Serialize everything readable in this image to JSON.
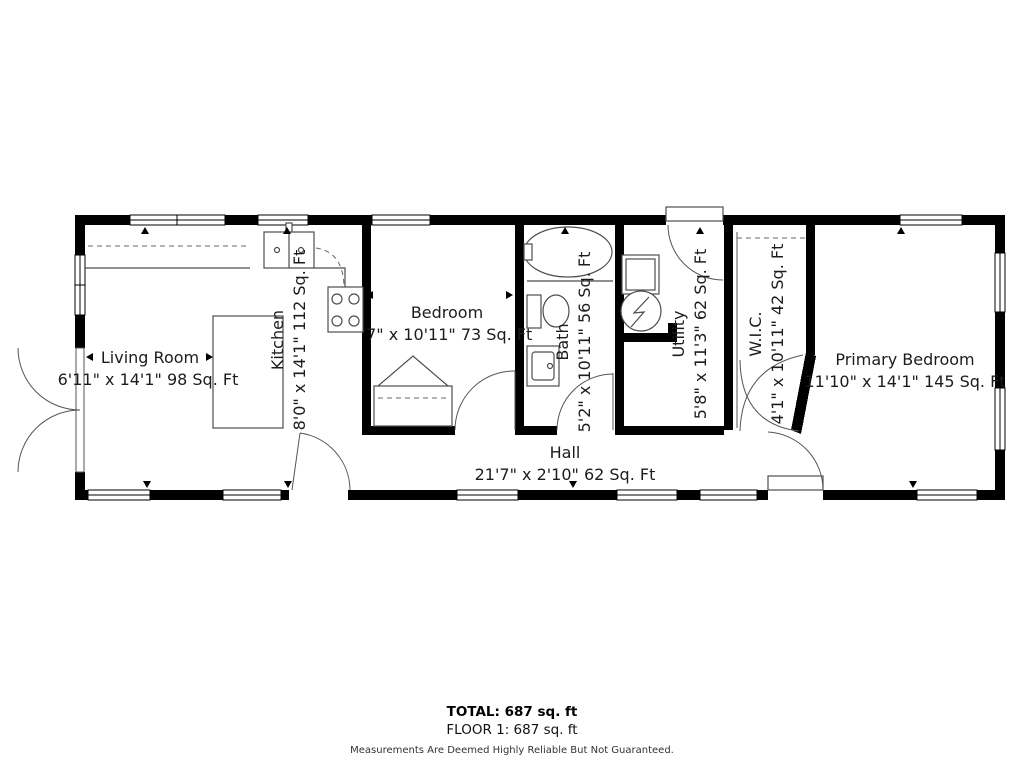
{
  "rooms": {
    "living_room": {
      "name": "Living Room",
      "dims": "6'11\" x 14'1\" 98 Sq. Ft"
    },
    "kitchen": {
      "name": "Kitchen",
      "dims": "8'0\" x 14'1\" 112 Sq. Ft"
    },
    "bedroom": {
      "name": "Bedroom",
      "dims": "'7\" x 10'11\" 73 Sq. Ft"
    },
    "bath": {
      "name": "Bath",
      "dims": "5'2\" x 10'11\" 56 Sq. Ft"
    },
    "utility": {
      "name": "Utility",
      "dims": "5'8\" x 11'3\" 62 Sq. Ft"
    },
    "wic": {
      "name": "W.I.C.",
      "dims": "4'1\" x 10'11\" 42 Sq. Ft"
    },
    "primary_bedroom": {
      "name": "Primary Bedroom",
      "dims": "11'10\" x 14'1\" 145 Sq. Ft"
    },
    "hall": {
      "name": "Hall",
      "dims": "21'7\" x 2'10\" 62 Sq. Ft"
    }
  },
  "footer": {
    "total": "TOTAL: 687 sq. ft",
    "floor": "FLOOR 1: 687 sq. ft",
    "disclaimer": "Measurements Are Deemed Highly Reliable But Not Guaranteed."
  },
  "icons": {
    "fixtures": [
      "kitchen-sink",
      "stove",
      "kitchen-island",
      "bathtub",
      "toilet",
      "bathroom-vanity",
      "washer",
      "water-heater",
      "closet-bifold-doors",
      "wic-double-doors",
      "french-doors",
      "interior-door",
      "exterior-door",
      "window"
    ]
  },
  "style": {
    "wall_color": "#000000",
    "background": "#ffffff",
    "fixture_line_color": "#4d4d4d",
    "text_color": "#1c1c1c"
  }
}
